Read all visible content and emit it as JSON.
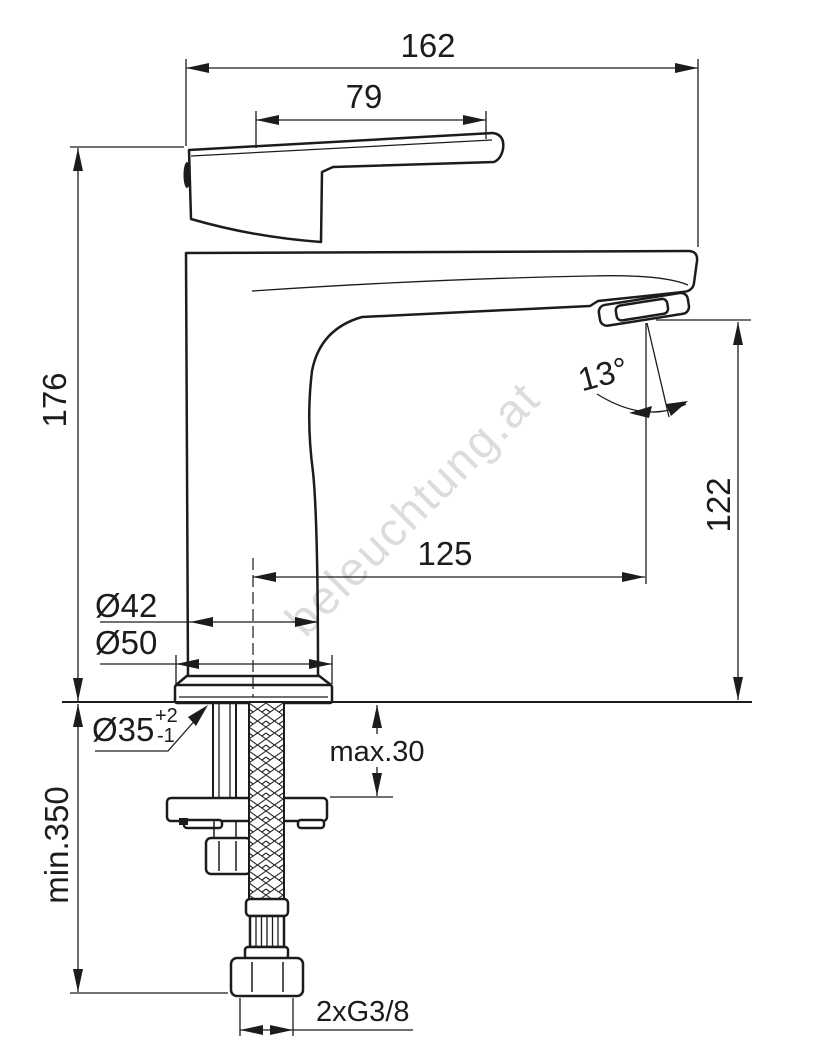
{
  "drawing": {
    "watermark": "beleuchtung.at",
    "labels": {
      "overall_width": "162",
      "handle_length": "79",
      "overall_height": "176",
      "spout_angle": "13°",
      "outlet_height": "122",
      "spout_reach": "125",
      "body_diameter": "Ø42",
      "base_diameter": "Ø50",
      "hole_diameter": "Ø35",
      "hole_tol_upper": "+2",
      "hole_tol_lower": "-1",
      "deck_thickness": "max.30",
      "hose_length": "min.350",
      "connection": "2xG3/8"
    },
    "colors": {
      "line": "#1c1c1c",
      "watermark": "#d9d9d9",
      "background": "#ffffff"
    }
  }
}
